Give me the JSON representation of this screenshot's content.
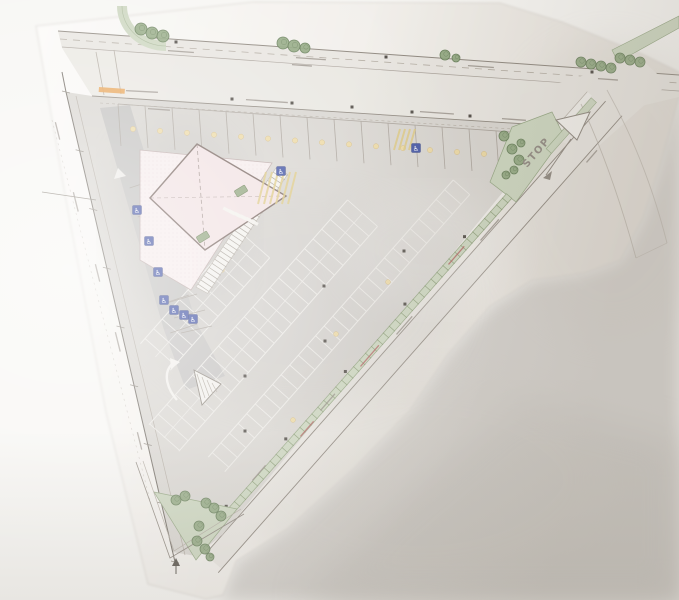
{
  "meta": {
    "artifact": "photograph of a printed architectural site plan",
    "site_shape": "triangular corner lot bounded by a top road and a diagonal road"
  },
  "labels": {
    "stop": "STOP",
    "handicap_symbol": "♿"
  },
  "facts": {
    "buildings": 1,
    "top_row_stalls": 15,
    "accessible_symbols": 9,
    "traffic_islands": 2,
    "tree_count": 30
  },
  "palette": {
    "photo_bg": "#f7f6f3",
    "shadow": "#d6d3cf",
    "shadow_deep": "#cbc8c3",
    "paper_light": "#fbfaf8",
    "paper_dark": "#e8e4de",
    "line_dark": "#6f6961",
    "line_med": "#8d867d",
    "line_light": "#b2aba1",
    "asphalt": "#d8d5d0",
    "aisle": "#c1c0be",
    "pavement": "#e8e5e0",
    "sidewalk": "#efede9",
    "stall_line": "#eceae6",
    "stall_line_dark": "#a9a29a",
    "green_fill": "#ccd6bf",
    "green_stroke": "#93a581",
    "green_dash": "#7e9168",
    "tree_fill": "#8fa67e",
    "tree_stroke": "#5e7750",
    "building_fill": "#f1e1e2",
    "building_stroke": "#77655f",
    "plaza_fill": "#f6ecec",
    "plaza_stroke": "#bcaaa8",
    "handicap_blue": "#3f51a3",
    "marking_yellow": "#ddc87e",
    "dot_yellow": "#ecd9a4",
    "red_note": "#b05d5d",
    "orange_note": "#e89f4c",
    "white_marking": "#f2f0ec",
    "pole_dark": "#4f4a44"
  },
  "drawing": {
    "trees": [
      [
        141,
        29,
        6
      ],
      [
        152,
        33,
        6
      ],
      [
        163,
        36,
        6
      ],
      [
        283,
        43,
        6
      ],
      [
        294,
        46,
        6
      ],
      [
        305,
        48,
        5
      ],
      [
        445,
        55,
        5
      ],
      [
        456,
        58,
        4
      ],
      [
        581,
        62,
        5
      ],
      [
        591,
        64,
        5
      ],
      [
        601,
        66,
        5
      ],
      [
        611,
        68,
        5
      ],
      [
        620,
        58,
        5
      ],
      [
        630,
        60,
        5
      ],
      [
        640,
        62,
        5
      ],
      [
        504,
        136,
        5
      ],
      [
        512,
        149,
        5
      ],
      [
        519,
        160,
        5
      ],
      [
        514,
        170,
        4
      ],
      [
        506,
        175,
        4
      ],
      [
        521,
        143,
        4
      ],
      [
        176,
        500,
        5
      ],
      [
        185,
        496,
        5
      ],
      [
        206,
        503,
        5
      ],
      [
        214,
        508,
        5
      ],
      [
        221,
        516,
        5
      ],
      [
        199,
        526,
        5
      ],
      [
        197,
        541,
        5
      ],
      [
        205,
        549,
        5
      ],
      [
        210,
        557,
        4
      ]
    ],
    "handicap_icons": [
      [
        137,
        210
      ],
      [
        149,
        241
      ],
      [
        158,
        272
      ],
      [
        164,
        300
      ],
      [
        174,
        310
      ],
      [
        184,
        315
      ],
      [
        193,
        319
      ],
      [
        281,
        171
      ],
      [
        416,
        148
      ]
    ],
    "gray_marks": [
      [
        168,
        50,
        26,
        4
      ],
      [
        296,
        57,
        30,
        4
      ],
      [
        468,
        65,
        26,
        4
      ],
      [
        598,
        78,
        20,
        4
      ],
      [
        246,
        99,
        42,
        4
      ],
      [
        420,
        111,
        34,
        4
      ],
      [
        502,
        118,
        24,
        4
      ],
      [
        126,
        90,
        32,
        3
      ],
      [
        292,
        64,
        20,
        4
      ],
      [
        148,
        108,
        22,
        4
      ],
      [
        56,
        122,
        18,
        76
      ],
      [
        74,
        192,
        20,
        76
      ],
      [
        96,
        264,
        18,
        76
      ],
      [
        116,
        332,
        20,
        76
      ],
      [
        138,
        432,
        18,
        76
      ],
      [
        480,
        240,
        28,
        -49
      ],
      [
        396,
        334,
        24,
        -49
      ],
      [
        320,
        410,
        22,
        -49
      ],
      [
        252,
        480,
        20,
        -49
      ],
      [
        586,
        162,
        16,
        -49
      ]
    ],
    "red_marks": [
      [
        360,
        366,
        28,
        -49
      ],
      [
        448,
        264,
        24,
        -49
      ],
      [
        300,
        436,
        20,
        -49
      ]
    ],
    "orange_mark": [
      99,
      87,
      26,
      4
    ],
    "yellow_field_dots": [
      [
        222,
        270
      ],
      [
        336,
        334
      ],
      [
        293,
        420
      ],
      [
        388,
        282
      ]
    ],
    "dark_squares": [
      [
        176,
        42
      ],
      [
        386,
        57
      ],
      [
        592,
        72
      ],
      [
        232,
        99
      ],
      [
        292,
        103
      ],
      [
        352,
        107
      ],
      [
        412,
        112
      ],
      [
        470,
        116
      ],
      [
        404,
        251
      ],
      [
        325,
        341
      ],
      [
        245,
        431
      ],
      [
        324,
        286
      ],
      [
        245,
        376
      ]
    ]
  }
}
